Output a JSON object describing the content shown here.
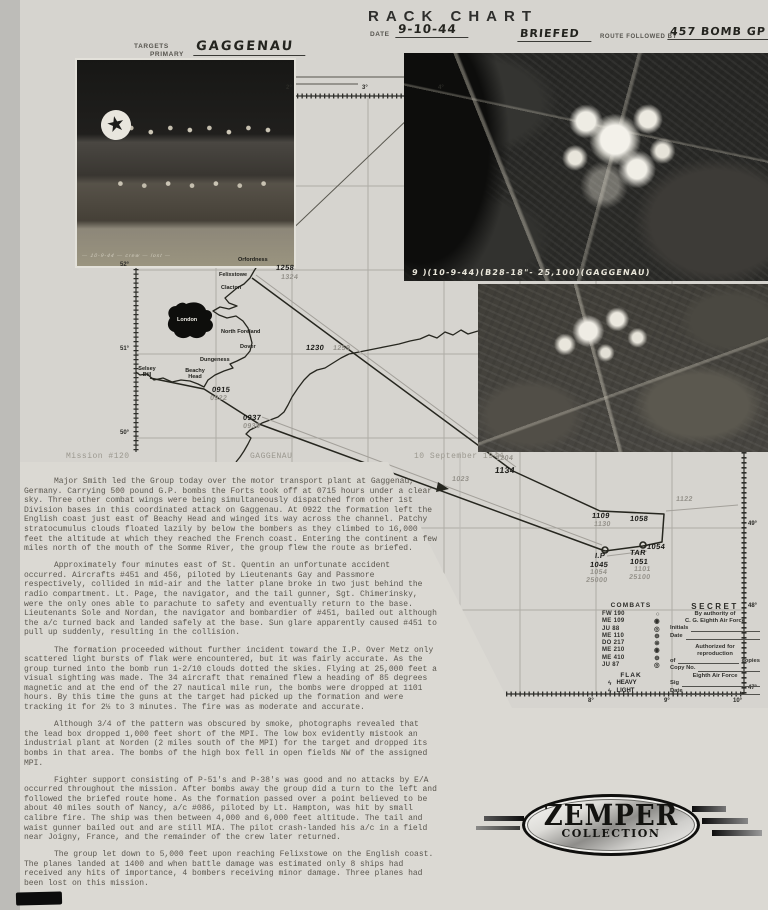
{
  "header": {
    "title": "RACK CHART",
    "date_label": "DATE",
    "date": "9-10-44",
    "briefed": "BRIEFED",
    "route_followed": "ROUTE FOLLOWED BY",
    "group": "457 BOMB GP"
  },
  "targets": {
    "label1": "TARGETS",
    "label2": "PRIMARY",
    "value": "GAGGENAU"
  },
  "icons": {
    "star": "★"
  },
  "photos": {
    "crew_caption": "— 10-9-44 — crew — lost —",
    "aerial_caption": "9 )(10-9-44)(B28-18\"- 25,100)(GAGGENAU)"
  },
  "map": {
    "ticks_top": [
      "2°",
      "3°",
      "4°"
    ],
    "ticks_left": [
      "52°",
      "51°",
      "50°"
    ],
    "ticks_right": [
      "49°",
      "48°",
      "47°"
    ],
    "ticks_bottom": [
      "8°",
      "9°",
      "10°"
    ],
    "places": {
      "orfordness": "Orfordness",
      "felixstowe": "Felixstowe",
      "clacton": "Clacton",
      "london": "London",
      "north_foreland": "North Foreland",
      "dover": "Dover",
      "dungeness": "Dungeness",
      "beachy_head": "Beachy Head",
      "selsey_bill": "Selsey Bill"
    },
    "times": {
      "felixstowe_ink": "1258",
      "felixstowe_pencil": "1324",
      "coast_out_ink": "0915",
      "coast_out_pencil": "0922",
      "channel_ink": "0937",
      "channel_pencil": "0938",
      "coast_return_ink": "1230",
      "coast_return_pencil": "1259",
      "france_pencil": "1023",
      "leg_pencil": "1204",
      "leg_ink": "1134",
      "rally_ink": "1109",
      "rally_pencil": "1130",
      "turn_ink": "1058",
      "after_target_ink": "1054",
      "east_pencil": "1122"
    },
    "target_box": {
      "ip_label": "I.P",
      "ip_time": "1045",
      "ip_time_pencil": "1054",
      "ip_alt_pencil": "25000",
      "tar_label": "TAR",
      "tar_time": "1051",
      "tar_time_pencil": "1101",
      "tar_alt_pencil": "25100"
    }
  },
  "combats": {
    "title": "COMBATS",
    "items": [
      {
        "name": "FW 190",
        "sym": "○"
      },
      {
        "name": "ME 109",
        "sym": "◉"
      },
      {
        "name": "JU 88",
        "sym": "◎"
      },
      {
        "name": "ME 110",
        "sym": "⊕"
      },
      {
        "name": "DO 217",
        "sym": "⊗"
      },
      {
        "name": "ME 210",
        "sym": "◉"
      },
      {
        "name": "ME 410",
        "sym": "⊕"
      },
      {
        "name": "JU 87",
        "sym": "◎"
      }
    ],
    "flak": {
      "title": "FLAK",
      "items": [
        {
          "sym": "ϟ",
          "name": "HEAVY"
        },
        {
          "sym": "ϟ",
          "name": "LIGHT"
        }
      ]
    }
  },
  "secret": {
    "title": "SECRET",
    "by1": "By authority of",
    "by2": "C. G. Eighth Air Force",
    "initials": "Initials",
    "date1": "Date",
    "auth1": "Authorized for",
    "auth2": "reproduction",
    "of": "of",
    "copies": "copies",
    "copy_no": "Copy No.",
    "force": "Eighth Air Force",
    "sig": "Sig",
    "date2": "Date"
  },
  "mission": {
    "number": "Mission #120",
    "target": "GAGGENAU",
    "date": "10 September 1944"
  },
  "narrative": {
    "paragraphs": [
      "Major Smith led the Group today over the motor transport plant at Gaggenau, Germany.  Carrying 500 pound G.P. bombs the Forts took off at 0715 hours under a clear sky.  Three other combat wings were being simultaneously dispatched from other 1st Division bases in this coordinated attack on Gaggenau.  At 0922 the formation left the English coast just east of Beachy Head and winged its way across the channel.  Patchy stratocumulus clouds floated lazily by below the bombers as they climbed to 16,000 feet the altitude at which they reached the French coast.  Entering the continent a few miles north of the mouth of the Somme River, the group flew the route as briefed.",
      "Approximately four minutes east of St. Quentin an unfortunate accident occurred. Aircrafts #451 and 456, piloted by Lieutenants Gay and Passmore respectively, collided in mid-air and the latter plane broke in two just behind the radio compartment. Lt. Page, the navigator, and the tail gunner, Sgt. Chimerinsky, were the only ones able to parachute to safety and eventually return to the base.  Lieutenants Sole and Nordan, the navigator and bombardier of #451, bailed out although the a/c turned back and landed safely at the base.  Sun glare apparently caused #451 to pull up suddenly, resulting in the collision.",
      "The formation proceeded without further incident toward the I.P.  Over Metz only scattered light bursts of flak were encountered, but it was fairly accurate. As the group turned into the bomb run 1-2/10 clouds dotted the skies.  Flying at 25,000 feet a visual sighting was made.  The 34 aircraft that remained flew a heading of 85 degrees magnetic and at the end of the 27 nautical mile run, the bombs were dropped at 1101 hours.  By this time the guns at the target had picked up the formation and were tracking it for 2½ to 3 minutes.  The fire was as moderate and accurate.",
      "Although 3/4 of the pattern was obscured by smoke, photographs revealed that the lead box dropped 1,000 feet short of the MPI.  The low box evidently mistook an industrial plant at Norden (2 miles south of the MPI) for the target and dropped its bombs in that area.  The bombs of the high box fell in open fields NW of the assigned MPI.",
      "Fighter support consisting of P-51's and P-38's was good and no attacks by E/A occurred throughout the mission.  After bombs away the group did a turn to the left and followed the briefed route home.  As the formation passed over a point believed to be about 40 miles south of Nancy, a/c #086, piloted by Lt. Hampton, was hit by small calibre fire.  The ship was then between 4,000 and 6,000 feet altitude. The tail and waist gunner bailed out and are still MIA.  The pilot crash-landed his a/c in a field near Joigny, France, and the remainder of the crew later returned.",
      "The group let down to 5,000 feet upon reaching Felixstowe on the English coast. The planes landed at 1400 and when battle damage was estimated only 8 ships had received any hits of importance, 4 bombers receiving minor damage.  Three planes had been lost on this mission."
    ]
  },
  "logo": {
    "line1": "ZEMPER",
    "line2": "COLLECTION"
  }
}
